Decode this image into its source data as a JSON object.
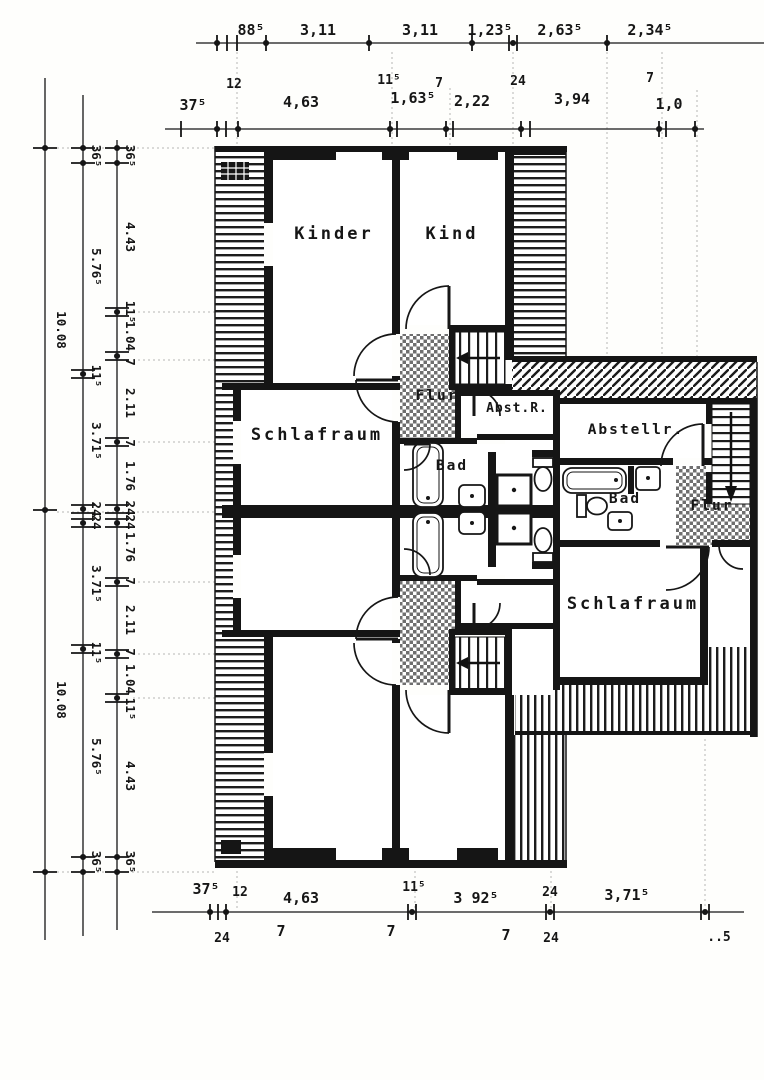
{
  "colors": {
    "ink": "#151515",
    "halftone": "#6f6f6f",
    "paper": "#fefefc"
  },
  "rooms": {
    "kinder": "Kinder",
    "kind": "Kind",
    "schlafraum_upper": "Schlafraum",
    "schlafraum_right": "Schlafraum",
    "bad_upper": "Bad",
    "bad_right": "Bad",
    "flur_upper": "Flur",
    "flur_right": "Flur",
    "abst_r": "Abst.R.",
    "abstellr": "Abstellr."
  },
  "dims": {
    "t1": [
      "88⁵",
      "3,11",
      "3,11",
      "1,23⁵",
      "2,63⁵",
      "2,34⁵"
    ],
    "t2": [
      "37⁵",
      "4,63",
      "1,63⁵",
      "2,22",
      "3,94",
      "1,0"
    ],
    "t2s": [
      "12",
      "11⁵",
      "7",
      "24",
      "7"
    ],
    "b1": [
      "37⁵",
      "12",
      "4,63",
      "11⁵",
      "3 92⁵",
      "24",
      "3,71⁵"
    ],
    "b2": [
      "24",
      "7",
      "7",
      "7",
      "24",
      "..5"
    ],
    "l1": [
      "10.08",
      "10.08"
    ],
    "l2": [
      "36⁵",
      "5.76⁵",
      "11⁵",
      "3.71⁵",
      "24",
      "24",
      "3.71⁵",
      "11⁵",
      "5.76⁵",
      "36⁵"
    ],
    "l3": [
      "36⁵",
      "4.43",
      "11⁵",
      "1.04",
      "7",
      "2.11",
      "7",
      "1.76",
      "24",
      "24",
      "1.76",
      "7",
      "2.11",
      "7",
      "1.04",
      "11⁵",
      "4.43",
      "36⁵"
    ]
  }
}
